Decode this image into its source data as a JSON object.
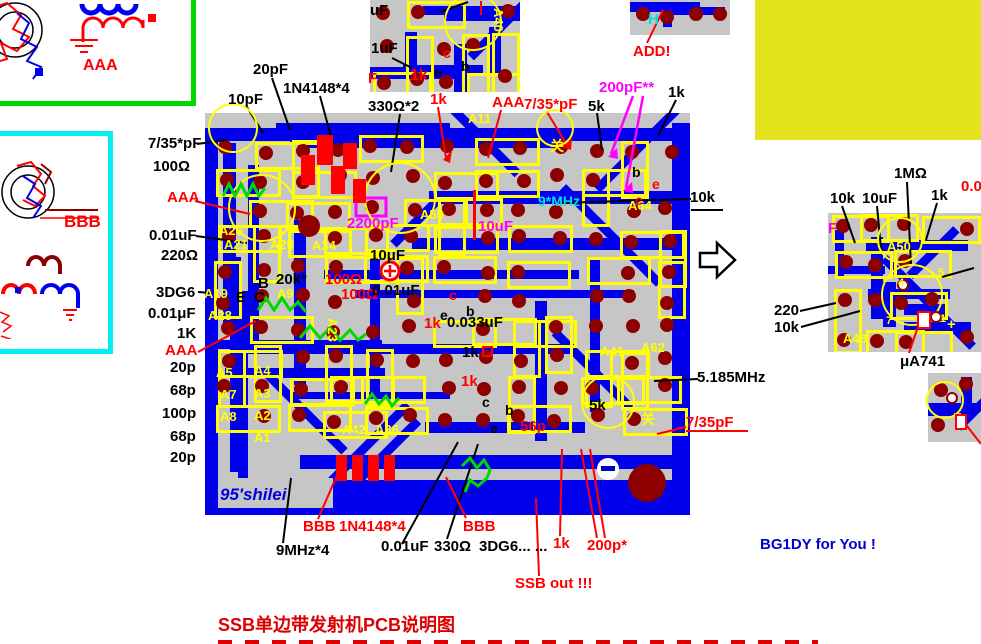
{
  "page": {
    "caption": "SSB单边带发射机PCB说明图",
    "signature": "BG1DY for You !",
    "board_brand": "95'shilei"
  },
  "schematic_boxes": {
    "top_box_label": "AAA",
    "left_box_label": "BBB"
  },
  "colors": {
    "board_gray": "#c6c6c6",
    "trace_blue": "#0000ee",
    "pad_maroon": "#8e0000",
    "silkscreen_yellow": "#ffff00",
    "coil_green": "#00d800",
    "highlight_red": "#ff0000",
    "magenta": "#ff00ff",
    "big_block_yellow": "#e4e41e"
  },
  "callouts": [
    {
      "t": "7/35*pF",
      "x": 148,
      "y": 136,
      "c": "#000000"
    },
    {
      "t": "100Ω",
      "x": 153,
      "y": 159,
      "c": "#000000"
    },
    {
      "t": "AAA",
      "x": 167,
      "y": 190,
      "c": "#ff0000"
    },
    {
      "t": "0.01uF",
      "x": 149,
      "y": 228,
      "c": "#000000"
    },
    {
      "t": "220Ω",
      "x": 161,
      "y": 248,
      "c": "#000000"
    },
    {
      "t": "3DG6",
      "x": 156,
      "y": 285,
      "c": "#000000"
    },
    {
      "t": "0.01μF",
      "x": 148,
      "y": 306,
      "c": "#000000"
    },
    {
      "t": "1K",
      "x": 177,
      "y": 326,
      "c": "#000000"
    },
    {
      "t": "AAA",
      "x": 165,
      "y": 343,
      "c": "#ff0000"
    },
    {
      "t": "20p",
      "x": 170,
      "y": 360,
      "c": "#000000"
    },
    {
      "t": "68p",
      "x": 170,
      "y": 383,
      "c": "#000000"
    },
    {
      "t": "100p",
      "x": 162,
      "y": 406,
      "c": "#000000"
    },
    {
      "t": "68p",
      "x": 170,
      "y": 429,
      "c": "#000000"
    },
    {
      "t": "20p",
      "x": 170,
      "y": 450,
      "c": "#000000"
    },
    {
      "t": "10pF",
      "x": 228,
      "y": 92,
      "c": "#000000"
    },
    {
      "t": "20pF",
      "x": 253,
      "y": 62,
      "c": "#000000"
    },
    {
      "t": "1N4148*4",
      "x": 283,
      "y": 81,
      "c": "#000000"
    },
    {
      "t": "330Ω*2",
      "x": 368,
      "y": 99,
      "c": "#000000"
    },
    {
      "t": "1k",
      "x": 430,
      "y": 92,
      "c": "#ff0000"
    },
    {
      "t": "AAA",
      "x": 492,
      "y": 95,
      "c": "#ff0000"
    },
    {
      "t": "7/35*pF",
      "x": 524,
      "y": 97,
      "c": "#ff0000"
    },
    {
      "t": "5k",
      "x": 588,
      "y": 99,
      "c": "#000000"
    },
    {
      "t": "200pF**",
      "x": 599,
      "y": 80,
      "c": "#ff00ff"
    },
    {
      "t": "1k",
      "x": 668,
      "y": 85,
      "c": "#000000"
    },
    {
      "t": "ADD!",
      "x": 633,
      "y": 44,
      "c": "#ff0000"
    },
    {
      "t": "10k",
      "x": 690,
      "y": 190,
      "c": "#000000"
    },
    {
      "t": "10k",
      "x": 830,
      "y": 191,
      "c": "#000000"
    },
    {
      "t": "10uF",
      "x": 862,
      "y": 191,
      "c": "#000000"
    },
    {
      "t": "1MΩ",
      "x": 894,
      "y": 166,
      "c": "#000000"
    },
    {
      "t": "1k",
      "x": 931,
      "y": 188,
      "c": "#000000"
    },
    {
      "t": "0.0",
      "x": 961,
      "y": 179,
      "c": "#ff0000"
    },
    {
      "t": "220",
      "x": 774,
      "y": 303,
      "c": "#000000"
    },
    {
      "t": "10k",
      "x": 774,
      "y": 320,
      "c": "#000000"
    },
    {
      "t": "μA741",
      "x": 900,
      "y": 354,
      "c": "#000000"
    },
    {
      "t": "9MHz*4",
      "x": 276,
      "y": 543,
      "c": "#000000"
    },
    {
      "t": "BBB",
      "x": 303,
      "y": 519,
      "c": "#ff0000"
    },
    {
      "t": "1N4148*4",
      "x": 339,
      "y": 519,
      "c": "#ff0000"
    },
    {
      "t": "0.01uF",
      "x": 381,
      "y": 539,
      "c": "#000000"
    },
    {
      "t": "330Ω",
      "x": 434,
      "y": 539,
      "c": "#000000"
    },
    {
      "t": "BBB",
      "x": 463,
      "y": 519,
      "c": "#ff0000"
    },
    {
      "t": "3DG6... ...",
      "x": 479,
      "y": 539,
      "c": "#000000"
    },
    {
      "t": "1k",
      "x": 553,
      "y": 536,
      "c": "#ff0000"
    },
    {
      "t": "200p*",
      "x": 587,
      "y": 538,
      "c": "#ff0000"
    },
    {
      "t": "SSB out !!!",
      "x": 515,
      "y": 576,
      "c": "#ff0000"
    },
    {
      "t": "5.185MHz",
      "x": 697,
      "y": 370,
      "c": "#000000"
    },
    {
      "t": "7/35pF",
      "x": 686,
      "y": 415,
      "c": "#ff0000"
    }
  ],
  "board_texts": [
    {
      "t": "A26",
      "x": 219,
      "y": 224,
      "c": "y",
      "fs": 13
    },
    {
      "t": "A21",
      "x": 224,
      "y": 238,
      "c": "y",
      "fs": 13
    },
    {
      "t": "A29",
      "x": 270,
      "y": 238,
      "c": "y",
      "fs": 13
    },
    {
      "t": "A34",
      "x": 312,
      "y": 239,
      "c": "y",
      "fs": 13
    },
    {
      "t": "A19",
      "x": 204,
      "y": 287,
      "c": "y",
      "fs": 13
    },
    {
      "t": "A9",
      "x": 277,
      "y": 287,
      "c": "y",
      "fs": 13
    },
    {
      "t": "A28",
      "x": 208,
      "y": 309,
      "c": "y",
      "fs": 13
    },
    {
      "t": "A23",
      "x": 339,
      "y": 318,
      "c": "y",
      "fs": 13,
      "rot": 90
    },
    {
      "t": "A59",
      "x": 420,
      "y": 208,
      "c": "y",
      "fs": 13
    },
    {
      "t": "A11",
      "x": 468,
      "y": 112,
      "c": "y",
      "fs": 13
    },
    {
      "t": "A64",
      "x": 628,
      "y": 199,
      "c": "y",
      "fs": 13
    },
    {
      "t": "A41",
      "x": 600,
      "y": 345,
      "c": "y",
      "fs": 13
    },
    {
      "t": "A62",
      "x": 641,
      "y": 341,
      "c": "y",
      "fs": 13
    },
    {
      "t": "A5",
      "x": 216,
      "y": 366,
      "c": "y",
      "fs": 13
    },
    {
      "t": "A4",
      "x": 254,
      "y": 364,
      "c": "y",
      "fs": 13
    },
    {
      "t": "A3",
      "x": 254,
      "y": 387,
      "c": "y",
      "fs": 13
    },
    {
      "t": "A2",
      "x": 254,
      "y": 409,
      "c": "y",
      "fs": 13
    },
    {
      "t": "A1",
      "x": 254,
      "y": 431,
      "c": "y",
      "fs": 13
    },
    {
      "t": "A7",
      "x": 220,
      "y": 388,
      "c": "y",
      "fs": 13
    },
    {
      "t": "A8",
      "x": 220,
      "y": 410,
      "c": "y",
      "fs": 13
    },
    {
      "t": "A42",
      "x": 342,
      "y": 423,
      "c": "y",
      "fs": 13
    },
    {
      "t": "A36",
      "x": 375,
      "y": 423,
      "c": "y",
      "fs": 13
    },
    {
      "t": "A48",
      "x": 843,
      "y": 332,
      "c": "y",
      "fs": 13
    },
    {
      "t": "A50",
      "x": 887,
      "y": 240,
      "c": "y",
      "fs": 13
    },
    {
      "t": "A40",
      "x": 505,
      "y": 8,
      "c": "y",
      "fs": 13,
      "rot": 90
    },
    {
      "t": "95'shilei",
      "x": 220,
      "y": 486,
      "c": "#0000e0",
      "fs": 17,
      "i": 1
    },
    {
      "t": "9*MHz",
      "x": 538,
      "y": 194,
      "c": "#00e0e0",
      "fs": 14
    },
    {
      "t": "关",
      "x": 550,
      "y": 139,
      "c": "y",
      "fs": 14
    },
    {
      "t": "关",
      "x": 641,
      "y": 412,
      "c": "y",
      "fs": 14
    },
    {
      "t": "2200pF",
      "x": 347,
      "y": 216,
      "c": "#ff00ff",
      "fs": 15
    },
    {
      "t": "10uF",
      "x": 478,
      "y": 219,
      "c": "#ff00ff",
      "fs": 15
    },
    {
      "t": "10μF",
      "x": 370,
      "y": 248,
      "c": "#000000",
      "fs": 15
    },
    {
      "t": "100Ω",
      "x": 325,
      "y": 272,
      "c": "#ff0000",
      "fs": 15
    },
    {
      "t": "100Ω",
      "x": 341,
      "y": 287,
      "c": "#ff0000",
      "fs": 15
    },
    {
      "t": "20k*",
      "x": 276,
      "y": 272,
      "c": "#000000",
      "fs": 15
    },
    {
      "t": "B",
      "x": 258,
      "y": 276,
      "c": "#000000",
      "fs": 15
    },
    {
      "t": "E",
      "x": 236,
      "y": 290,
      "c": "#000000",
      "fs": 15
    },
    {
      "t": "C",
      "x": 254,
      "y": 290,
      "c": "#000000",
      "fs": 15
    },
    {
      "t": "0.01uF",
      "x": 372,
      "y": 283,
      "c": "#000000",
      "fs": 15
    },
    {
      "t": "c",
      "x": 449,
      "y": 288,
      "c": "#ff0000",
      "fs": 14
    },
    {
      "t": "e",
      "x": 440,
      "y": 308,
      "c": "#000000",
      "fs": 14
    },
    {
      "t": "b",
      "x": 466,
      "y": 304,
      "c": "#000000",
      "fs": 14
    },
    {
      "t": "0.033uF",
      "x": 447,
      "y": 315,
      "c": "#000000",
      "fs": 15
    },
    {
      "t": "1k",
      "x": 424,
      "y": 316,
      "c": "#ff0000",
      "fs": 15
    },
    {
      "t": "1k",
      "x": 462,
      "y": 345,
      "c": "#000000",
      "fs": 15
    },
    {
      "t": "1k",
      "x": 461,
      "y": 374,
      "c": "#ff0000",
      "fs": 15
    },
    {
      "t": "c",
      "x": 482,
      "y": 395,
      "c": "#000000",
      "fs": 14
    },
    {
      "t": "b",
      "x": 505,
      "y": 403,
      "c": "#000000",
      "fs": 14
    },
    {
      "t": "e",
      "x": 490,
      "y": 421,
      "c": "#000000",
      "fs": 14
    },
    {
      "t": "56p",
      "x": 520,
      "y": 419,
      "c": "#ff0000",
      "fs": 15
    },
    {
      "t": "5k",
      "x": 589,
      "y": 398,
      "c": "#000000",
      "fs": 15
    },
    {
      "t": "b",
      "x": 632,
      "y": 165,
      "c": "#000000",
      "fs": 14
    },
    {
      "t": "e",
      "x": 652,
      "y": 177,
      "c": "#ff0000",
      "fs": 14
    },
    {
      "t": "c",
      "x": 635,
      "y": 193,
      "c": "#ff0000",
      "fs": 14
    },
    {
      "t": "uF",
      "x": 370,
      "y": 3,
      "c": "#000000",
      "fs": 15
    },
    {
      "t": "1uF",
      "x": 371,
      "y": 41,
      "c": "#000000",
      "fs": 15
    },
    {
      "t": "F",
      "x": 368,
      "y": 71,
      "c": "#ff0000",
      "fs": 15
    },
    {
      "t": "1k",
      "x": 410,
      "y": 68,
      "c": "#ff0000",
      "fs": 16
    },
    {
      "t": "c",
      "x": 443,
      "y": 46,
      "c": "#ff0000",
      "fs": 14
    },
    {
      "t": "e",
      "x": 434,
      "y": 65,
      "c": "#000000",
      "fs": 14
    },
    {
      "t": "b",
      "x": 461,
      "y": 59,
      "c": "#000000",
      "fs": 14
    },
    {
      "t": "H",
      "x": 648,
      "y": 12,
      "c": "#00e0e0",
      "fs": 15
    },
    {
      "t": "F",
      "x": 828,
      "y": 221,
      "c": "#ff00ff",
      "fs": 15
    },
    {
      "t": "+",
      "x": 947,
      "y": 317,
      "c": "y",
      "fs": 15
    },
    {
      "t": "4",
      "x": 898,
      "y": 278,
      "c": "y",
      "fs": 11
    },
    {
      "t": "7",
      "x": 886,
      "y": 316,
      "c": "y",
      "fs": 11
    },
    {
      "t": "1",
      "x": 940,
      "y": 314,
      "c": "y",
      "fs": 11
    },
    {
      "t": "5",
      "x": 938,
      "y": 268,
      "c": "y",
      "fs": 11
    }
  ]
}
